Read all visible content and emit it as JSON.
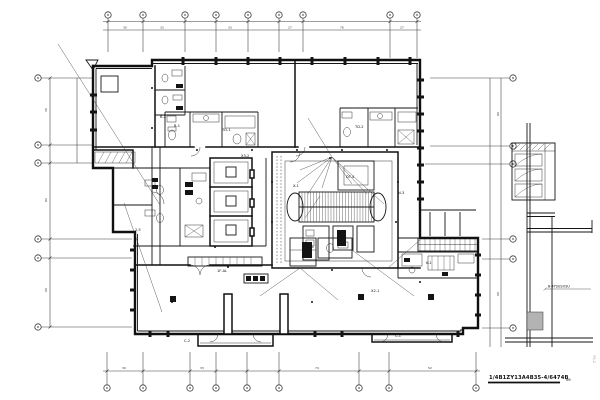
{
  "drawing": {
    "background": "#ffffff",
    "line_color": "#101010",
    "shade_color": "#b3b3b3",
    "title": "1/4B1ZY13A4B35-4/6474B",
    "title_suffix": "N9",
    "right_note": "B-4YSUSOSU",
    "side_vertical_note": "YS-2",
    "annotations": [
      "DT-4",
      "TD-1",
      "TD-2",
      "X3-2",
      "B-1",
      "AL-1",
      "1F-AL",
      "X2-1",
      "K-1",
      "C-2",
      "C-1",
      "N-3",
      "2.5",
      "B-2",
      "X-1"
    ],
    "dims": [
      "30",
      "33",
      "33",
      "27",
      "76",
      "27",
      "36",
      "84",
      "60",
      "30",
      "33",
      "74",
      "52",
      "68",
      "69"
    ]
  }
}
